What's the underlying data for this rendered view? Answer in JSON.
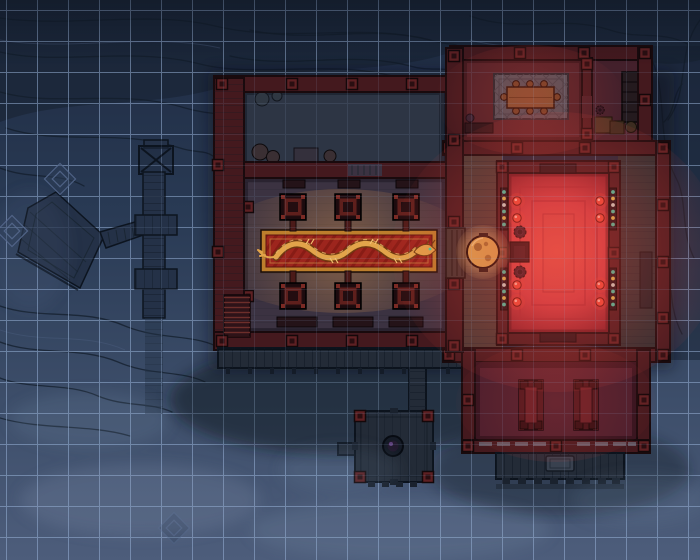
{
  "map": {
    "description": "Night-time top-down battle map of a cliffside temple: a pillared great hall with a golden dragon runner, a red-lit shrine room with a gong, an upper meeting room, a storeroom, a lower mess hall, and wooden cliff walkways",
    "grid": {
      "cell_px": 31,
      "offset_x": 7,
      "offset_y": 11,
      "columns": 22,
      "rows": 18
    },
    "features": {
      "great_hall": {
        "name": "great-hall",
        "pillars": 6,
        "benches": 3,
        "carpet": "golden-dragon-runner"
      },
      "courtyard": {
        "name": "north-court",
        "barrels": 2,
        "pots": 2,
        "crates": 1
      },
      "shrine_room": {
        "name": "red-lit-shrine",
        "lantern_orbs": 8,
        "bead_curtains": 4,
        "nested_carpet_rings": 3,
        "censers": 2
      },
      "gong": {
        "name": "golden-gong"
      },
      "meeting_room": {
        "name": "upper-meeting-room",
        "table_stools": 8,
        "floor_mat": "diamond-lattice"
      },
      "storeroom": {
        "name": "storeroom",
        "shelf": 1,
        "crates": 2,
        "barrel": 1
      },
      "mess_hall": {
        "name": "lower-mess-hall",
        "long_tables": 2,
        "stools_per_table": 4
      },
      "cliff_structures": {
        "name": "wooden-walkway",
        "platforms": 3,
        "trestle": 1,
        "rock_markers": 3
      },
      "well_platform": {
        "name": "well-platform",
        "basin": 1
      }
    }
  },
  "palette": {
    "bgTop": "#1e2a41",
    "bgMid": "#293a54",
    "bgLow": "#3d4e6a",
    "bgBottom": "#4d5d7b",
    "crevice": "#131d2b",
    "ridgeHi": "#4e6184",
    "rockShade": "#16202e",
    "gridLine": "#9db8dd",
    "wood": "#243147",
    "woodDark": "#0c141f",
    "woodSeam": "#18242f",
    "deck": "#232b37",
    "deckSeam": "#101823",
    "deckPost": "#141c28",
    "wall": "#44191e",
    "wallDark": "#190a0d",
    "wallHi": "#6e2724",
    "post": "#5e2023",
    "postCore": "#2a0e11",
    "postDark": "#14080a",
    "courtFloor": "#2d3544",
    "hallFloor": "#3b3241",
    "hallGlow": "#eba050",
    "carpetRed": "#9d251d",
    "carpetStripe": "#881c15",
    "carpetGold": "#bd7e2c",
    "carpetGoldHi": "#d09a48",
    "dragon": "#e2a44a",
    "dragonDark": "#6e3c10",
    "dragonHi": "#f2c070",
    "dragonEye": "#35d2a8",
    "pillarFrame": "#1c0b0e",
    "pillarRed": "#5e1f1c",
    "pillarCore": "#230d10",
    "pillarKnob": "#7a2a24",
    "throneCore": "#ee5a4e",
    "throneMid": "#cf3d44",
    "throneDim": "#93242e",
    "throneEdge": "#6b1a24",
    "throneLine": "#a82a34",
    "throneInner": "#d14b4a",
    "redSpill": "#e8463c",
    "gong": "#d9a94f",
    "gongDark": "#8a5c24",
    "gongHi": "#f2d58a",
    "gongGlow": "#f8c878",
    "bead1": "#3cc9a6",
    "bead2": "#d9c050",
    "bead3": "#c8d8cc",
    "beadBar": "#120c14",
    "orb": "#f04a38",
    "orbDark": "#5e0f0a",
    "porchWest": "#463a35",
    "porchEast": "#2c2f31",
    "annexFloor": "#4c2027",
    "storeFloor": "#43202b",
    "mat": "#4c525b",
    "matLine": "#394049",
    "matEdge": "#20262e",
    "tableWood": "#7c5130",
    "tableEdge": "#231106",
    "stool": "#6a4226",
    "shelf": "#241a1e",
    "crate": "#463323",
    "crateEdge": "#1c1208",
    "barrel": "#3c2c20",
    "messFloor": "#491e2d",
    "messTable": "#3c1118",
    "messRail": "#4a161d",
    "messTableIn": "#621e26",
    "stoolDark": "#2e0d12",
    "rail": "#7e8897",
    "mist": "#8fa2bd",
    "fog": "#7e92ae",
    "shadow": "#0e151f",
    "benchDark": "#241318",
    "stepStone": "#3b3330",
    "barrelWood": "#3a2f33",
    "crateCourt": "#34303c",
    "wellRim": "#151b26",
    "wellIn": "#221a2e",
    "wellGlint": "#6a4a8a"
  }
}
